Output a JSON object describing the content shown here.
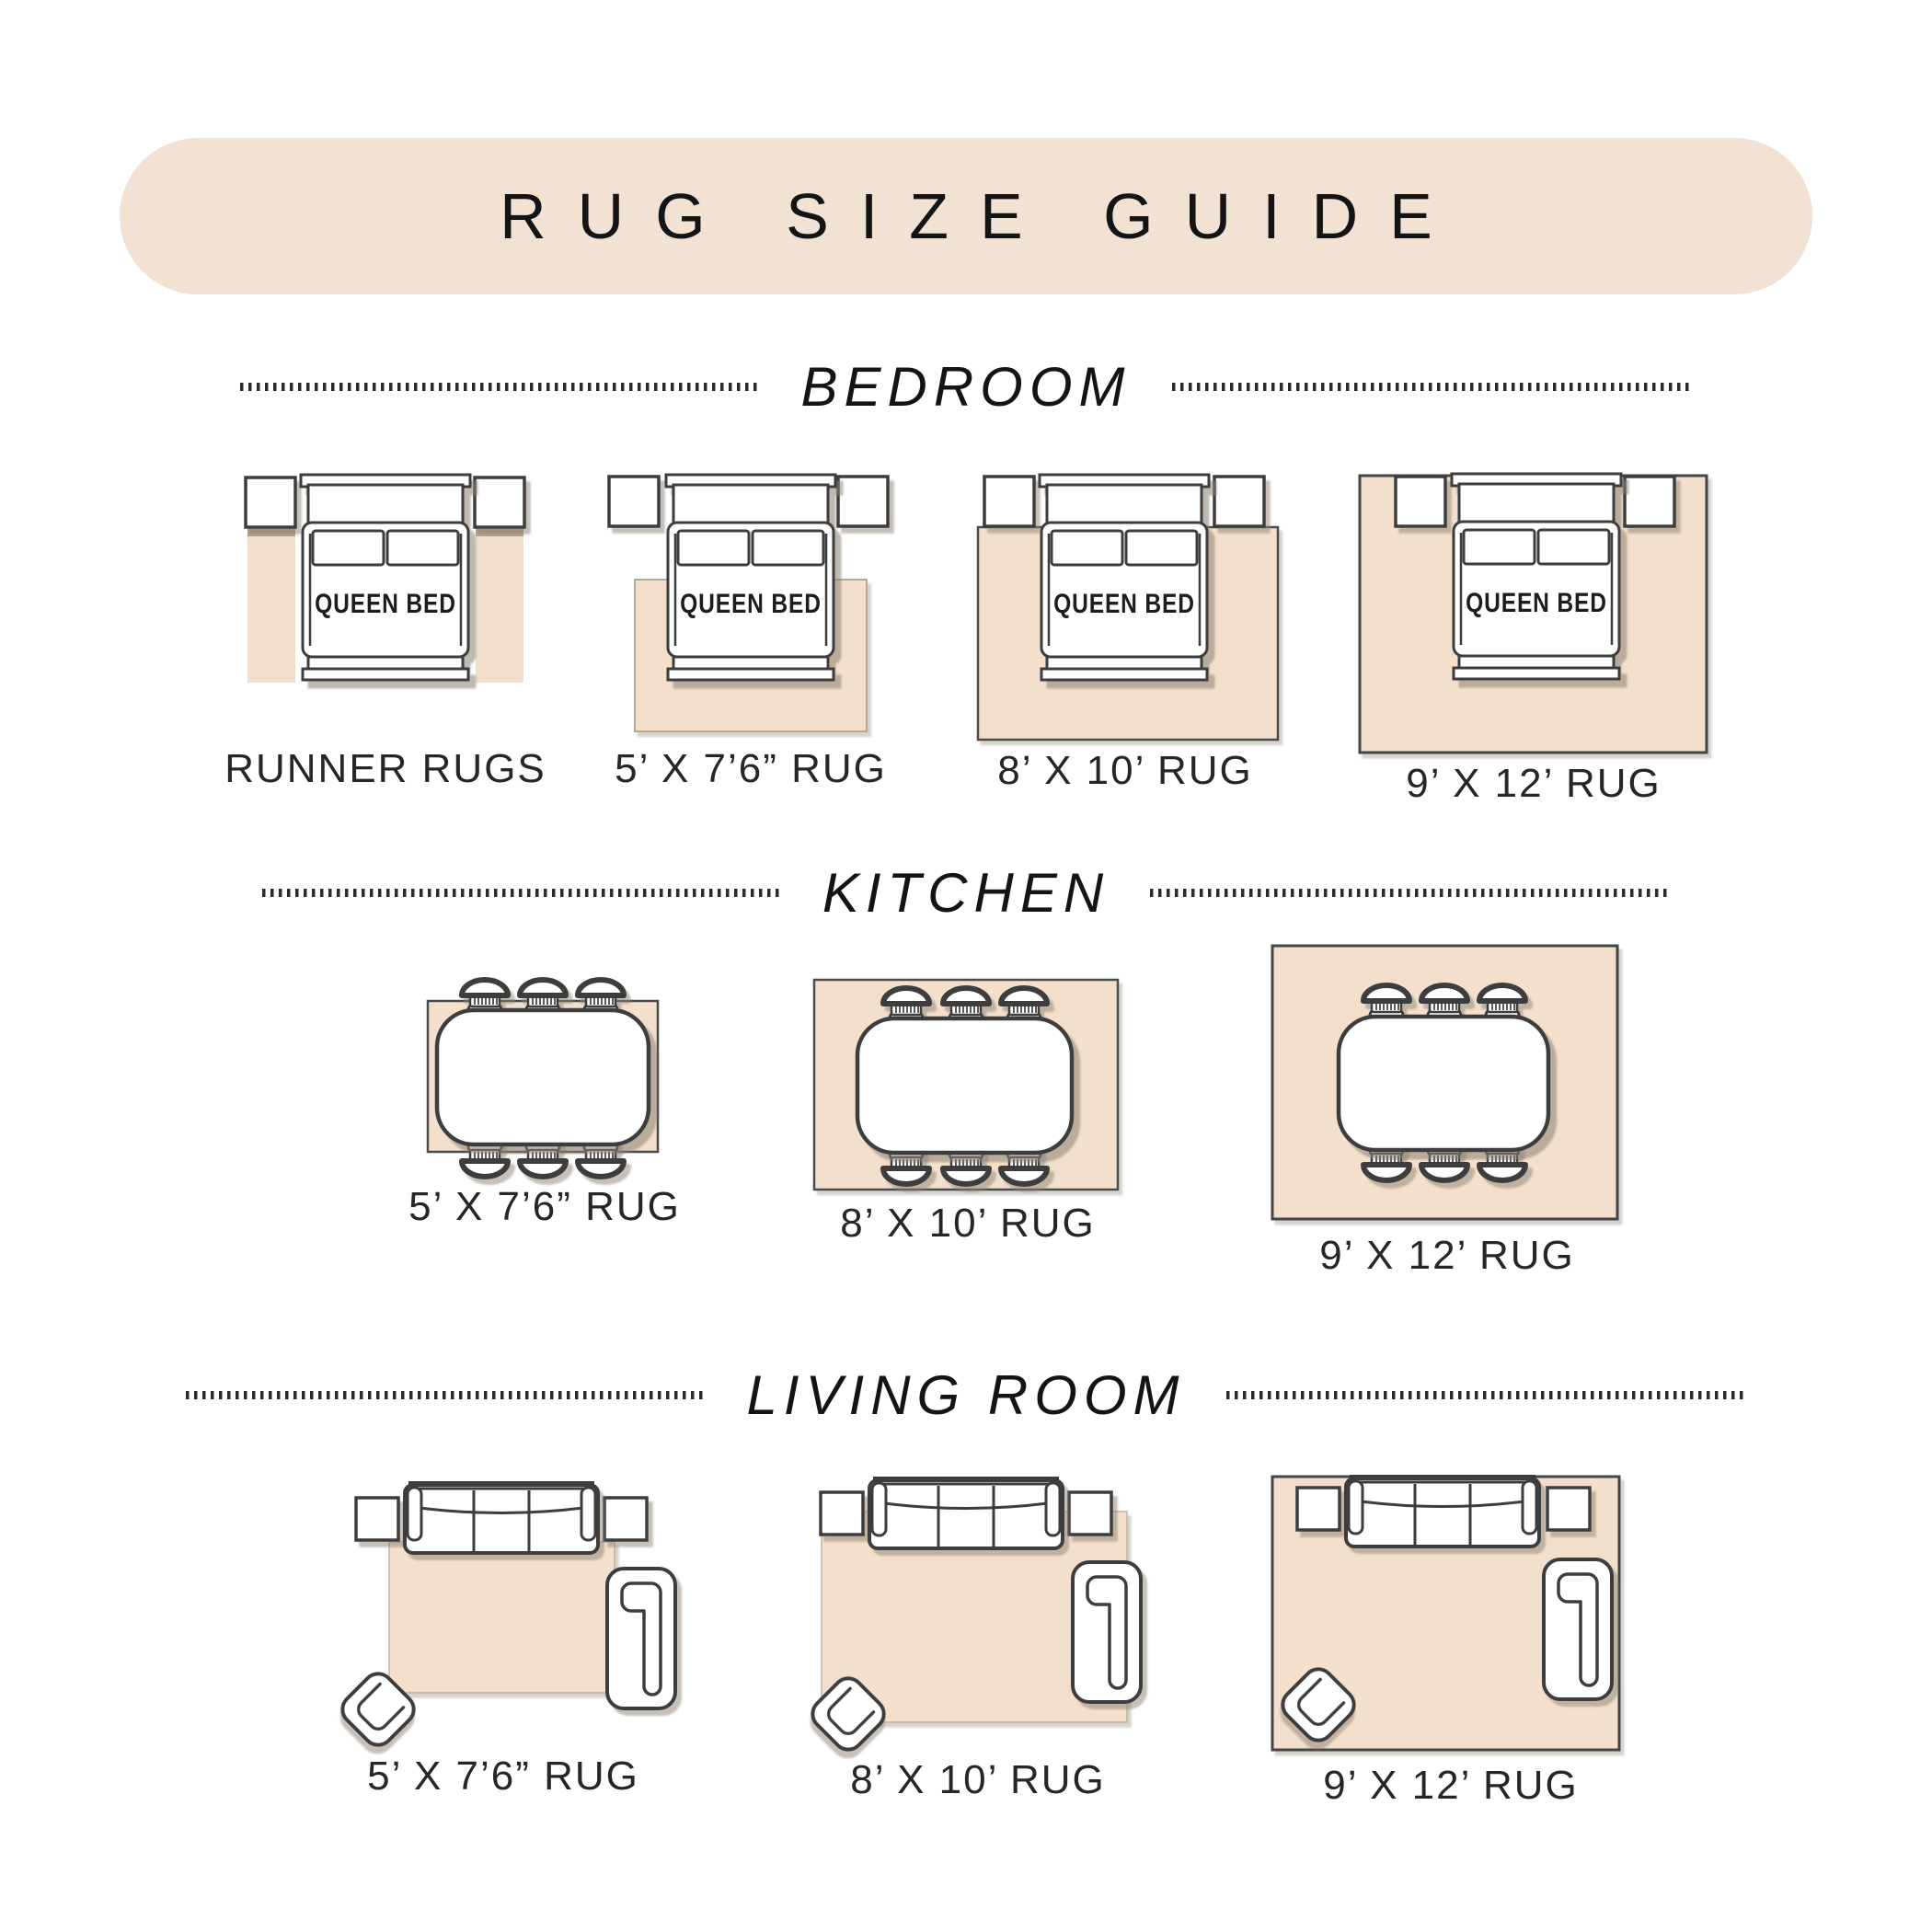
{
  "title": "RUG SIZE GUIDE",
  "sections": {
    "bedroom": {
      "label": "BEDROOM",
      "bed_label": "QUEEN BED",
      "items": [
        {
          "label": "RUNNER RUGS"
        },
        {
          "label": "5’ X 7’6” RUG"
        },
        {
          "label": "8’ X 10’ RUG"
        },
        {
          "label": "9’ X 12’ RUG"
        }
      ]
    },
    "kitchen": {
      "label": "KITCHEN",
      "items": [
        {
          "label": "5’ X 7’6” RUG"
        },
        {
          "label": "8’ X 10’ RUG"
        },
        {
          "label": "9’ X 12’ RUG"
        }
      ]
    },
    "living_room": {
      "label": "LIVING ROOM",
      "items": [
        {
          "label": "5’ X 7’6” RUG"
        },
        {
          "label": "8’ X 10’ RUG"
        },
        {
          "label": "9’ X 12’ RUG"
        }
      ]
    }
  },
  "colors": {
    "banner_bg": "#f2e2d3",
    "rug_fill": "#f2e0cc",
    "outline": "#3d3d3d",
    "text": "#1c1c1c"
  }
}
